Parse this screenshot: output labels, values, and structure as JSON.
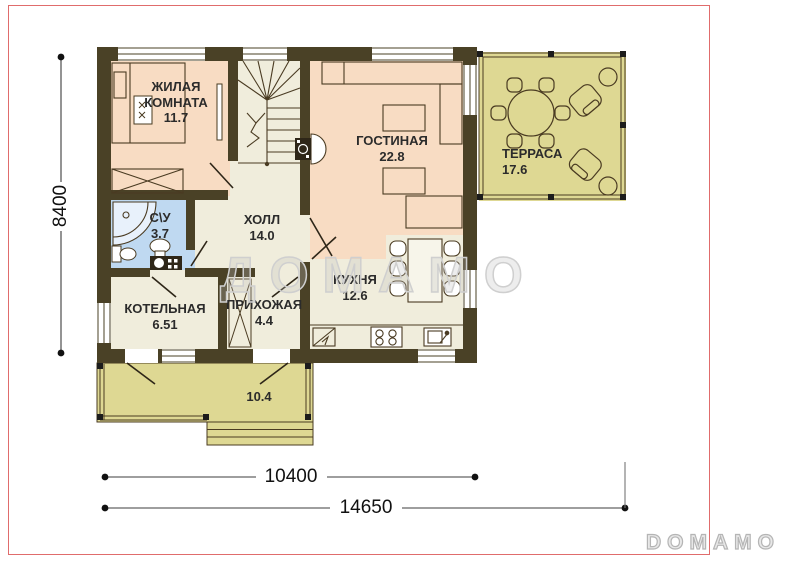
{
  "watermark": {
    "center_text": "ДОМАМО",
    "logo_text": "DOMAMO"
  },
  "dimensions": {
    "height_label": "8400",
    "inner_width_label": "10400",
    "outer_width_label": "14650"
  },
  "rooms": [
    {
      "id": "living",
      "name": "ЖИЛАЯ КОМНАТА",
      "area": "11.7"
    },
    {
      "id": "lounge",
      "name": "ГОСТИНАЯ",
      "area": "22.8"
    },
    {
      "id": "terrace",
      "name": "ТЕРРАСА",
      "area": "17.6"
    },
    {
      "id": "wc",
      "name": "С\\У",
      "area": "3.7"
    },
    {
      "id": "hall",
      "name": "ХОЛЛ",
      "area": "14.0"
    },
    {
      "id": "kitchen",
      "name": "КУХНЯ",
      "area": "12.6"
    },
    {
      "id": "boiler",
      "name": "КОТЕЛЬНАЯ",
      "area": "6.51"
    },
    {
      "id": "entry",
      "name": "ПРИХОЖАЯ",
      "area": "4.4"
    },
    {
      "id": "porch",
      "name": "",
      "area": "10.4"
    }
  ],
  "colors": {
    "wall": "#4a4126",
    "room_pink": "#f8dcc3",
    "room_cream": "#f0eddc",
    "room_blue": "#bfd9f1",
    "outdoor_olive": "#ded893",
    "crop_mark_red": "#e06c6c",
    "watermark_gray": "#cfcfcf"
  }
}
